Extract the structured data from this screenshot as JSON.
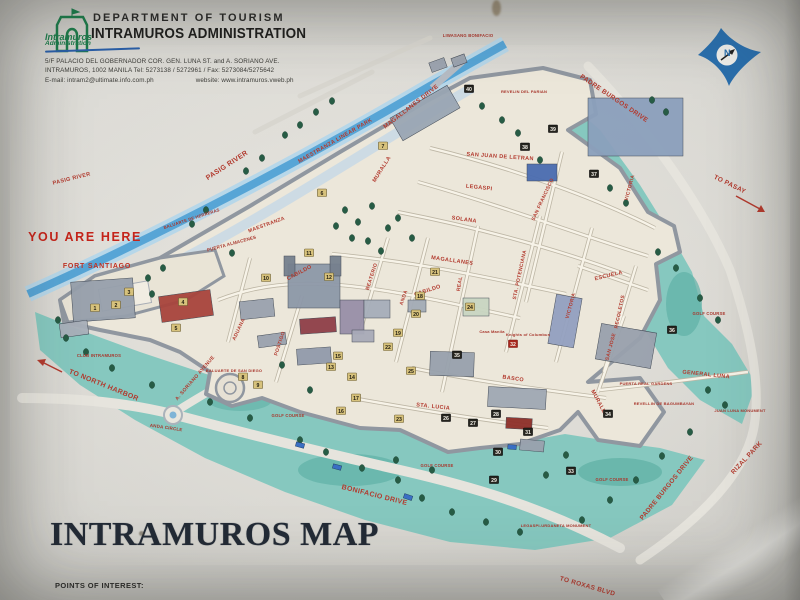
{
  "sign": {
    "header": {
      "dept": "DEPARTMENT OF TOURISM",
      "admin": "INTRAMUROS ADMINISTRATION",
      "logo_line1": "Intramuros",
      "logo_line2": "Administration",
      "address1": "5/F PALACIO DEL GOBERNADOR COR. GEN. LUNA ST. and A. SORIANO AVE.",
      "address2": "INTRAMUROS, 1002 MANILA      Tel:  5273138 / 5272961 / Fax:  5273084/5275642",
      "address3_email": "E-mail: intram2@ultimate.info.com.ph",
      "address3_web": "website: www.intramuros.vweb.ph"
    },
    "compass_letter": "N",
    "title": "INTRAMUROS MAP",
    "footer_label": "POINTS OF INTEREST:"
  },
  "colors": {
    "marker_gold": "#d7c27c",
    "marker_gold_text": "#201c10",
    "marker_dark": "#26251f",
    "marker_red": "#a9281d",
    "marker_light_text": "#f5f2ea",
    "tree": "#275c45",
    "tree_stroke": "#143d2c",
    "river": "#57a5d6",
    "moat": "#86c8bf",
    "label_red": "#b23a2e",
    "car_blue": "#3a6fc4"
  },
  "map": {
    "labels": [
      {
        "t": "PASIG RIVER",
        "x": 228,
        "y": 167,
        "r": -33,
        "s": 7,
        "cls": "street"
      },
      {
        "t": "PASIG RIVER",
        "x": 72,
        "y": 180,
        "r": -14,
        "s": 5.5,
        "cls": "street"
      },
      {
        "t": "MAESTRANZA LINEAR PARK",
        "x": 336,
        "y": 142,
        "r": -30,
        "s": 5.5,
        "cls": "street"
      },
      {
        "t": "MAGALLANES DRIVE",
        "x": 412,
        "y": 108,
        "r": -38,
        "s": 6,
        "cls": "street"
      },
      {
        "t": "PADRE BURGOS DRIVE",
        "x": 613,
        "y": 100,
        "r": 34,
        "s": 6.5,
        "cls": "street"
      },
      {
        "t": "TO PASAY",
        "x": 729,
        "y": 186,
        "r": 26,
        "s": 6.5,
        "cls": "street"
      },
      {
        "t": "PADRE BURGOS DRIVE",
        "x": 668,
        "y": 489,
        "r": -51,
        "s": 6.5,
        "cls": "street"
      },
      {
        "t": "RIZAL PARK",
        "x": 748,
        "y": 459,
        "r": -47,
        "s": 6.5,
        "cls": "street"
      },
      {
        "t": "TO ROXAS BLVD",
        "x": 587,
        "y": 588,
        "r": 16,
        "s": 6.5,
        "cls": "street"
      },
      {
        "t": "BONIFACIO DRIVE",
        "x": 374,
        "y": 497,
        "r": 14,
        "s": 7,
        "cls": "street"
      },
      {
        "t": "TO NORTH HARBOR",
        "x": 103,
        "y": 387,
        "r": 22,
        "s": 7,
        "cls": "street"
      },
      {
        "t": "A. SORIANO AVENUE",
        "x": 196,
        "y": 379,
        "r": -49,
        "s": 5,
        "cls": "street"
      },
      {
        "t": "MAESTRANZA",
        "x": 267,
        "y": 226,
        "r": -20,
        "s": 5,
        "cls": "street"
      },
      {
        "t": "ADUANA",
        "x": 240,
        "y": 330,
        "r": -65,
        "s": 5,
        "cls": "street"
      },
      {
        "t": "MURALLA",
        "x": 383,
        "y": 170,
        "r": -58,
        "s": 5.5,
        "cls": "street"
      },
      {
        "t": "MURALLA",
        "x": 598,
        "y": 404,
        "r": 62,
        "s": 5.5,
        "cls": "street"
      },
      {
        "t": "CABILDO",
        "x": 300,
        "y": 274,
        "r": -28,
        "s": 5.5,
        "cls": "street"
      },
      {
        "t": "CABILDO",
        "x": 428,
        "y": 292,
        "r": -18,
        "s": 5.5,
        "cls": "street"
      },
      {
        "t": "MAGALLANES",
        "x": 452,
        "y": 262,
        "r": 8,
        "s": 5.5,
        "cls": "street"
      },
      {
        "t": "SOLANA",
        "x": 464,
        "y": 221,
        "r": 8,
        "s": 5.5,
        "cls": "street"
      },
      {
        "t": "LEGASPI",
        "x": 479,
        "y": 189,
        "r": 6,
        "s": 5.5,
        "cls": "street"
      },
      {
        "t": "SAN JUAN DE LETRAN",
        "x": 500,
        "y": 158,
        "r": 4,
        "s": 5.5,
        "cls": "street"
      },
      {
        "t": "SAN FRANCISCO",
        "x": 544,
        "y": 200,
        "r": -65,
        "s": 5,
        "cls": "street"
      },
      {
        "t": "STA. POTENCIANA",
        "x": 521,
        "y": 275,
        "r": -78,
        "s": 5,
        "cls": "street"
      },
      {
        "t": "VICTORIA",
        "x": 572,
        "y": 306,
        "r": -75,
        "s": 5,
        "cls": "street"
      },
      {
        "t": "VICTORIA",
        "x": 631,
        "y": 188,
        "r": -75,
        "s": 5,
        "cls": "street"
      },
      {
        "t": "ESCUELA",
        "x": 609,
        "y": 277,
        "r": -14,
        "s": 5.5,
        "cls": "street"
      },
      {
        "t": "RECOLETOS",
        "x": 621,
        "y": 312,
        "r": -78,
        "s": 5,
        "cls": "street"
      },
      {
        "t": "SAN JOSE",
        "x": 612,
        "y": 347,
        "r": -75,
        "s": 5,
        "cls": "street"
      },
      {
        "t": "REAL",
        "x": 461,
        "y": 284,
        "r": -80,
        "s": 5,
        "cls": "street"
      },
      {
        "t": "ANDA",
        "x": 405,
        "y": 298,
        "r": -72,
        "s": 5,
        "cls": "street"
      },
      {
        "t": "BEATERIO",
        "x": 373,
        "y": 277,
        "r": -72,
        "s": 5,
        "cls": "street"
      },
      {
        "t": "POSTIGO",
        "x": 281,
        "y": 344,
        "r": -72,
        "s": 5,
        "cls": "street"
      },
      {
        "t": "BASCO",
        "x": 513,
        "y": 380,
        "r": 8,
        "s": 5.5,
        "cls": "street"
      },
      {
        "t": "STA. LUCIA",
        "x": 433,
        "y": 408,
        "r": 6,
        "s": 5.5,
        "cls": "street"
      },
      {
        "t": "GENERAL LUNA",
        "x": 706,
        "y": 376,
        "r": 6,
        "s": 5.5,
        "cls": "street"
      },
      {
        "t": "YOU ARE HERE",
        "x": 85,
        "y": 241,
        "r": 0,
        "s": 12.5,
        "cls": "you"
      },
      {
        "t": "FORT SANTIAGO",
        "x": 97,
        "y": 268,
        "r": 0,
        "s": 7,
        "cls": "fort"
      },
      {
        "t": "PUERTA ALMACENES",
        "x": 232,
        "y": 245,
        "r": -15,
        "s": 4.5,
        "cls": "place"
      },
      {
        "t": "BALUARTE DE HERRERAS",
        "x": 192,
        "y": 220,
        "r": -18,
        "s": 4.2,
        "cls": "place"
      },
      {
        "t": "CLUB INTRAMUROS",
        "x": 99,
        "y": 357,
        "r": 0,
        "s": 4.2,
        "cls": "place"
      },
      {
        "t": "BALUARTE DE SAN DIEGO",
        "x": 234,
        "y": 372,
        "r": 0,
        "s": 4,
        "cls": "place"
      },
      {
        "t": "ANDA CIRCLE",
        "x": 166,
        "y": 429,
        "r": 8,
        "s": 4.5,
        "cls": "place"
      },
      {
        "t": "GOLF COURSE",
        "x": 288,
        "y": 417,
        "r": 0,
        "s": 4.2,
        "cls": "place"
      },
      {
        "t": "GOLF COURSE",
        "x": 437,
        "y": 467,
        "r": 0,
        "s": 4.2,
        "cls": "place"
      },
      {
        "t": "GOLF COURSE",
        "x": 612,
        "y": 481,
        "r": 0,
        "s": 4.2,
        "cls": "place"
      },
      {
        "t": "GOLF COURSE",
        "x": 709,
        "y": 315,
        "r": 0,
        "s": 4.2,
        "cls": "place"
      },
      {
        "t": "LIWASANG BONIFACIO",
        "x": 468,
        "y": 37,
        "r": 0,
        "s": 4.2,
        "cls": "place"
      },
      {
        "t": "REVELIN DEL PARIAN",
        "x": 524,
        "y": 93,
        "r": 0,
        "s": 4,
        "cls": "place"
      },
      {
        "t": "PUERTA REAL GARDENS",
        "x": 646,
        "y": 385,
        "r": 0,
        "s": 4,
        "cls": "place"
      },
      {
        "t": "REVELLIN DE BAGUMBAYAN",
        "x": 664,
        "y": 405,
        "r": 0,
        "s": 4,
        "cls": "place"
      },
      {
        "t": "JUAN LUNA MONUMENT",
        "x": 740,
        "y": 412,
        "r": 0,
        "s": 4,
        "cls": "place"
      },
      {
        "t": "LEGASPI-URDANETA MONUMENT",
        "x": 556,
        "y": 527,
        "r": 0,
        "s": 4,
        "cls": "place"
      },
      {
        "t": "Casa Manila",
        "x": 492,
        "y": 333,
        "r": 0,
        "s": 4,
        "cls": "place"
      },
      {
        "t": "Knights of Columbus",
        "x": 528,
        "y": 336,
        "r": 0,
        "s": 4,
        "cls": "place"
      }
    ],
    "markers": [
      {
        "n": 1,
        "x": 95,
        "y": 308,
        "k": "g"
      },
      {
        "n": 2,
        "x": 116,
        "y": 305,
        "k": "g"
      },
      {
        "n": 3,
        "x": 129,
        "y": 292,
        "k": "g"
      },
      {
        "n": 4,
        "x": 183,
        "y": 302,
        "k": "g"
      },
      {
        "n": 5,
        "x": 176,
        "y": 328,
        "k": "g"
      },
      {
        "n": 6,
        "x": 322,
        "y": 193,
        "k": "g"
      },
      {
        "n": 7,
        "x": 383,
        "y": 146,
        "k": "g"
      },
      {
        "n": 8,
        "x": 243,
        "y": 377,
        "k": "g"
      },
      {
        "n": 9,
        "x": 258,
        "y": 385,
        "k": "g"
      },
      {
        "n": 10,
        "x": 266,
        "y": 278,
        "k": "g"
      },
      {
        "n": 11,
        "x": 309,
        "y": 253,
        "k": "g"
      },
      {
        "n": 12,
        "x": 329,
        "y": 277,
        "k": "g"
      },
      {
        "n": 13,
        "x": 331,
        "y": 367,
        "k": "g"
      },
      {
        "n": 14,
        "x": 352,
        "y": 377,
        "k": "g"
      },
      {
        "n": 15,
        "x": 338,
        "y": 356,
        "k": "g"
      },
      {
        "n": 16,
        "x": 341,
        "y": 411,
        "k": "g"
      },
      {
        "n": 17,
        "x": 356,
        "y": 398,
        "k": "g"
      },
      {
        "n": 18,
        "x": 420,
        "y": 296,
        "k": "g"
      },
      {
        "n": 19,
        "x": 398,
        "y": 333,
        "k": "g"
      },
      {
        "n": 20,
        "x": 416,
        "y": 314,
        "k": "g"
      },
      {
        "n": 21,
        "x": 435,
        "y": 272,
        "k": "g"
      },
      {
        "n": 22,
        "x": 388,
        "y": 347,
        "k": "g"
      },
      {
        "n": 23,
        "x": 399,
        "y": 419,
        "k": "g"
      },
      {
        "n": 24,
        "x": 470,
        "y": 307,
        "k": "g"
      },
      {
        "n": 25,
        "x": 411,
        "y": 371,
        "k": "g"
      },
      {
        "n": 26,
        "x": 446,
        "y": 418,
        "k": "d"
      },
      {
        "n": 27,
        "x": 473,
        "y": 423,
        "k": "d"
      },
      {
        "n": 28,
        "x": 496,
        "y": 414,
        "k": "d"
      },
      {
        "n": 29,
        "x": 494,
        "y": 480,
        "k": "d"
      },
      {
        "n": 30,
        "x": 498,
        "y": 452,
        "k": "d"
      },
      {
        "n": 31,
        "x": 528,
        "y": 432,
        "k": "d"
      },
      {
        "n": 32,
        "x": 513,
        "y": 344,
        "k": "r"
      },
      {
        "n": 33,
        "x": 571,
        "y": 471,
        "k": "d"
      },
      {
        "n": 34,
        "x": 608,
        "y": 414,
        "k": "d"
      },
      {
        "n": 35,
        "x": 457,
        "y": 355,
        "k": "d"
      },
      {
        "n": 36,
        "x": 672,
        "y": 330,
        "k": "d"
      },
      {
        "n": 37,
        "x": 594,
        "y": 174,
        "k": "d"
      },
      {
        "n": 38,
        "x": 525,
        "y": 147,
        "k": "d"
      },
      {
        "n": 39,
        "x": 553,
        "y": 129,
        "k": "d"
      },
      {
        "n": 40,
        "x": 469,
        "y": 89,
        "k": "d"
      }
    ],
    "trees": [
      [
        285,
        135
      ],
      [
        300,
        125
      ],
      [
        316,
        112
      ],
      [
        262,
        158
      ],
      [
        246,
        171
      ],
      [
        332,
        101
      ],
      [
        206,
        210
      ],
      [
        192,
        224
      ],
      [
        345,
        210
      ],
      [
        358,
        222
      ],
      [
        372,
        206
      ],
      [
        388,
        228
      ],
      [
        352,
        238
      ],
      [
        368,
        241
      ],
      [
        336,
        226
      ],
      [
        398,
        218
      ],
      [
        412,
        238
      ],
      [
        381,
        251
      ],
      [
        148,
        278
      ],
      [
        163,
        268
      ],
      [
        232,
        253
      ],
      [
        152,
        294
      ],
      [
        502,
        120
      ],
      [
        518,
        133
      ],
      [
        540,
        160
      ],
      [
        610,
        188
      ],
      [
        626,
        203
      ],
      [
        482,
        106
      ],
      [
        652,
        100
      ],
      [
        666,
        112
      ],
      [
        658,
        252
      ],
      [
        676,
        268
      ],
      [
        700,
        298
      ],
      [
        718,
        320
      ],
      [
        708,
        390
      ],
      [
        725,
        405
      ],
      [
        690,
        432
      ],
      [
        662,
        456
      ],
      [
        636,
        480
      ],
      [
        610,
        500
      ],
      [
        582,
        520
      ],
      [
        300,
        440
      ],
      [
        326,
        452
      ],
      [
        362,
        468
      ],
      [
        398,
        480
      ],
      [
        422,
        498
      ],
      [
        452,
        512
      ],
      [
        486,
        522
      ],
      [
        520,
        532
      ],
      [
        396,
        460
      ],
      [
        432,
        470
      ],
      [
        546,
        475
      ],
      [
        566,
        455
      ],
      [
        250,
        418
      ],
      [
        210,
        402
      ],
      [
        152,
        385
      ],
      [
        112,
        368
      ],
      [
        86,
        352
      ],
      [
        66,
        338
      ],
      [
        58,
        320
      ],
      [
        310,
        390
      ],
      [
        282,
        365
      ]
    ],
    "buildings": [
      {
        "x": 72,
        "y": 280,
        "w": 62,
        "h": 40,
        "c": "#97a0ac",
        "r": -4
      },
      {
        "x": 60,
        "y": 322,
        "w": 28,
        "h": 14,
        "c": "#a9b0ba",
        "r": -8
      },
      {
        "x": 160,
        "y": 293,
        "w": 52,
        "h": 26,
        "c": "#a8443c",
        "r": -8
      },
      {
        "x": 288,
        "y": 264,
        "w": 52,
        "h": 44,
        "c": "#8d98a8",
        "r": 0
      },
      {
        "x": 284,
        "y": 256,
        "w": 11,
        "h": 20,
        "c": "#76808e",
        "r": 0
      },
      {
        "x": 330,
        "y": 256,
        "w": 11,
        "h": 20,
        "c": "#76808e",
        "r": 0
      },
      {
        "x": 240,
        "y": 300,
        "w": 34,
        "h": 18,
        "c": "#9aa2ae",
        "r": -6
      },
      {
        "x": 300,
        "y": 318,
        "w": 36,
        "h": 15,
        "c": "#8f3f48",
        "r": -4
      },
      {
        "x": 258,
        "y": 334,
        "w": 28,
        "h": 12,
        "c": "#9aa2ae",
        "r": -8
      },
      {
        "x": 340,
        "y": 300,
        "w": 24,
        "h": 34,
        "c": "#988fa8",
        "r": 0
      },
      {
        "x": 297,
        "y": 348,
        "w": 34,
        "h": 16,
        "c": "#929bab",
        "r": -4
      },
      {
        "x": 364,
        "y": 300,
        "w": 26,
        "h": 18,
        "c": "#a6aeba",
        "r": 0
      },
      {
        "x": 408,
        "y": 300,
        "w": 18,
        "h": 12,
        "c": "#a3abb6",
        "r": 0
      },
      {
        "x": 352,
        "y": 330,
        "w": 22,
        "h": 12,
        "c": "#a8aab8",
        "r": 0
      },
      {
        "x": 430,
        "y": 352,
        "w": 44,
        "h": 24,
        "c": "#98a1ad",
        "r": 2
      },
      {
        "x": 488,
        "y": 388,
        "w": 58,
        "h": 20,
        "c": "#a0a8b4",
        "r": 3
      },
      {
        "x": 552,
        "y": 296,
        "w": 26,
        "h": 50,
        "c": "#93a0c0",
        "r": 10
      },
      {
        "x": 588,
        "y": 98,
        "w": 95,
        "h": 58,
        "c": "#8ba0bc",
        "r": 0
      },
      {
        "x": 392,
        "y": 100,
        "w": 66,
        "h": 26,
        "c": "#9aa6b4",
        "r": -30
      },
      {
        "x": 527,
        "y": 164,
        "w": 30,
        "h": 17,
        "c": "#4a6cb0",
        "r": 0
      },
      {
        "x": 430,
        "y": 60,
        "w": 16,
        "h": 10,
        "c": "#9aa2ae",
        "r": -20
      },
      {
        "x": 452,
        "y": 56,
        "w": 14,
        "h": 9,
        "c": "#9aa2ae",
        "r": -20
      },
      {
        "x": 463,
        "y": 298,
        "w": 26,
        "h": 18,
        "c": "#c9d6c2",
        "r": 0
      },
      {
        "x": 598,
        "y": 328,
        "w": 56,
        "h": 36,
        "c": "#99a1ad",
        "r": 10
      },
      {
        "x": 506,
        "y": 418,
        "w": 26,
        "h": 11,
        "c": "#8e2f29",
        "r": 3
      },
      {
        "x": 520,
        "y": 440,
        "w": 24,
        "h": 11,
        "c": "#9aa2ae",
        "r": 5
      }
    ],
    "cars": [
      [
        300,
        445,
        15
      ],
      [
        337,
        467,
        15
      ],
      [
        408,
        497,
        18
      ],
      [
        512,
        447,
        5
      ]
    ]
  }
}
